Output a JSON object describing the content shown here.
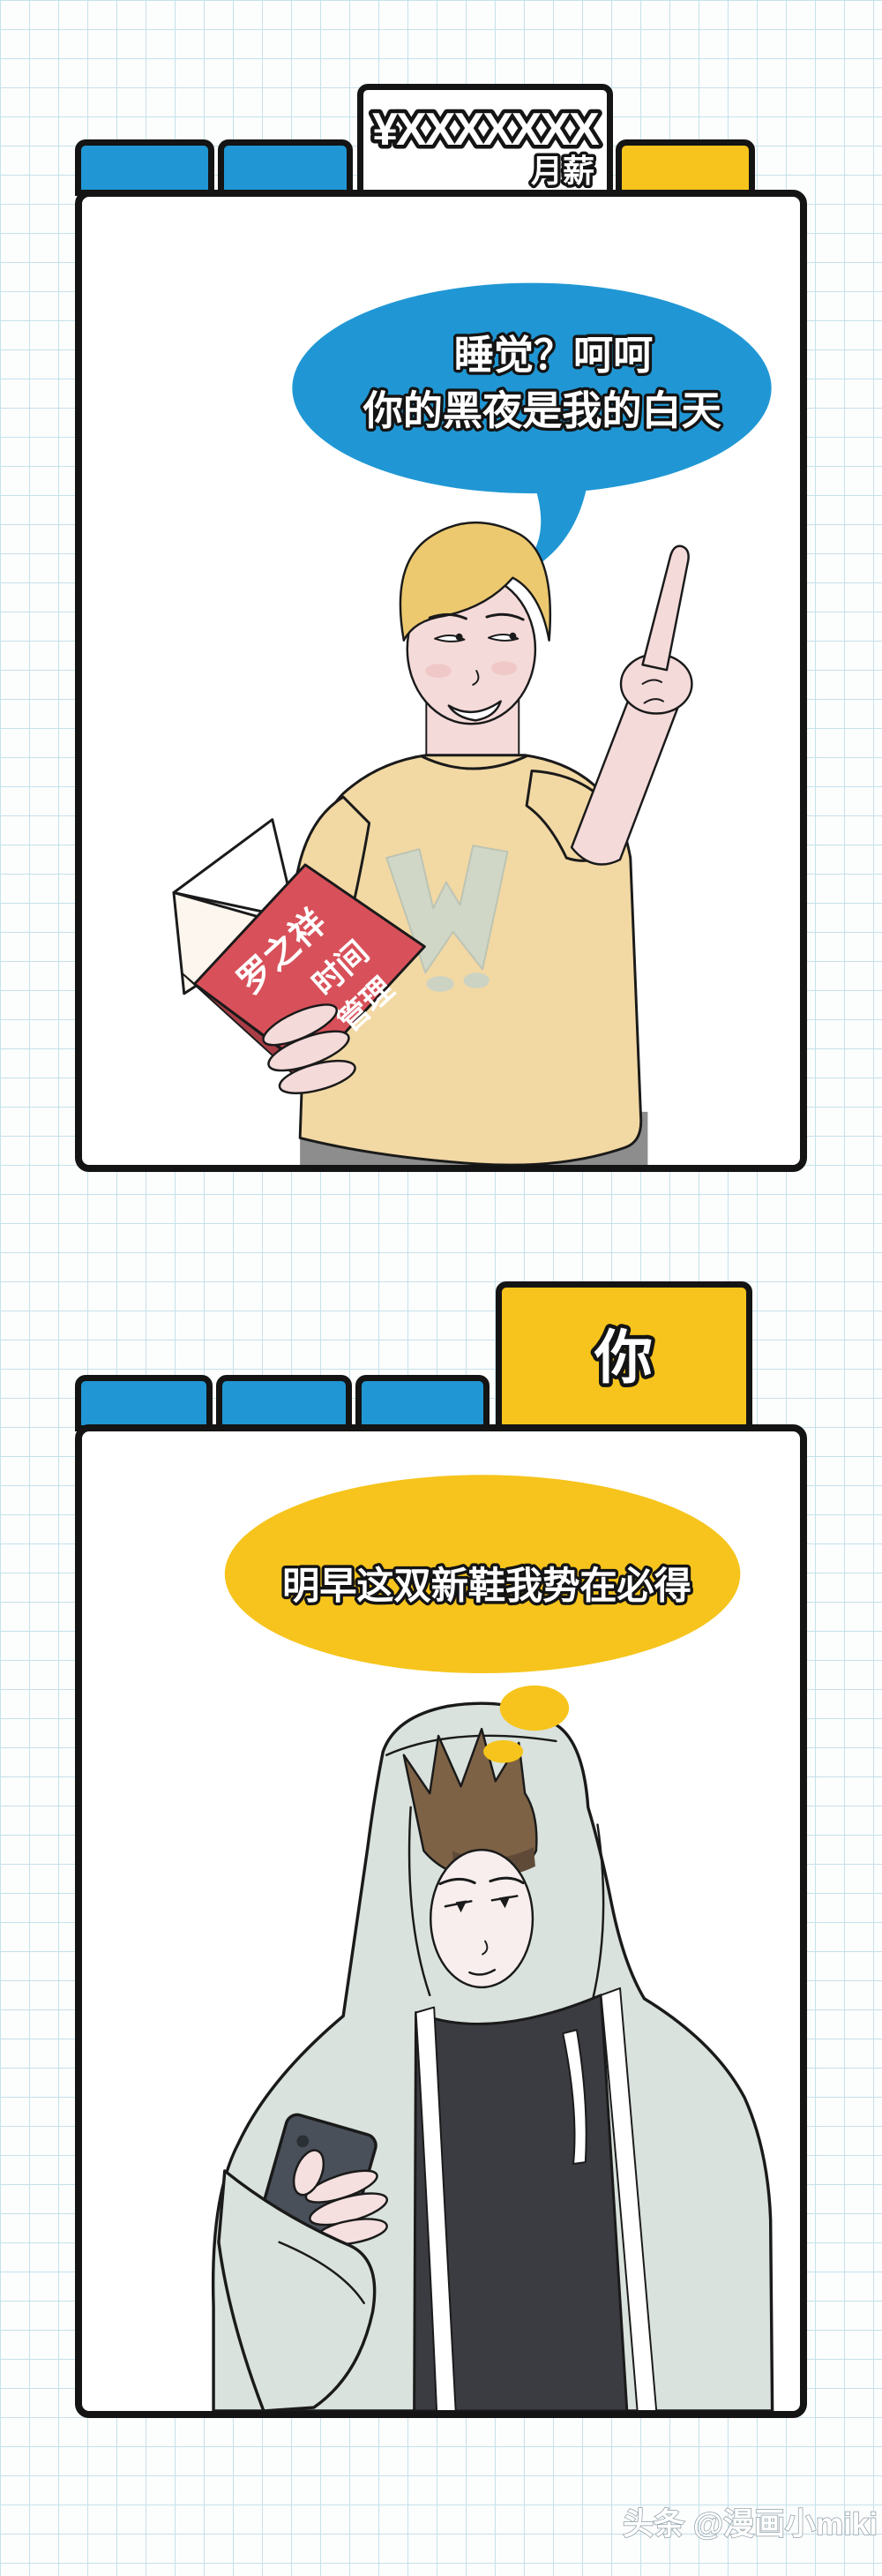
{
  "colors": {
    "blue": "#2097d4",
    "yellow": "#f6c41c",
    "panel_border": "#141414",
    "grid_line": "#c6e1eb",
    "book_red": "#d8515a",
    "book_spine_red": "#a93d45",
    "skin": "#f5dada",
    "skin_pale": "#f8eeee",
    "shirt_tan": "#f2d8a3",
    "hair_blonde": "#ecc96f",
    "hair_brown": "#7d6246",
    "hoodie_sage": "#d9e2dc",
    "black_shirt": "#3b3b42",
    "phone_gray": "#495059",
    "pants_gray": "#8d8d8d"
  },
  "panel1": {
    "money_tab": {
      "amount": "¥XXXXXXX",
      "label": "月薪"
    },
    "speech_bubble": {
      "line1": "睡觉？呵呵",
      "line2": "你的黑夜是我的白天"
    },
    "book": {
      "col1": "罗之祥",
      "col2": "时间",
      "col3": "管理"
    }
  },
  "panel2": {
    "you_tab": {
      "label": "你"
    },
    "thought_bubble": {
      "text": "明早这双新鞋我势在必得"
    }
  },
  "watermark": {
    "text": "头条 @漫画小miki"
  }
}
